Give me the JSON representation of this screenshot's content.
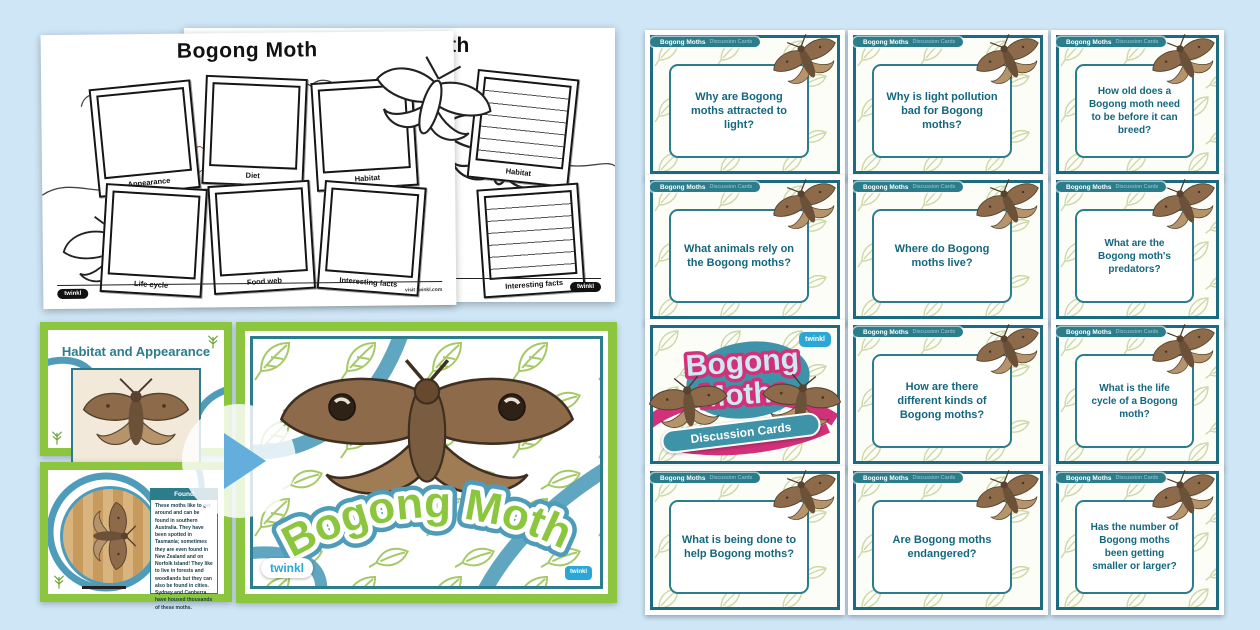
{
  "page": {
    "background": "#cfe6f6"
  },
  "worksheets": {
    "title": "Bogong Moth",
    "frames": [
      "Appearance",
      "Diet",
      "Habitat",
      "Life cycle",
      "Food web",
      "Interesting facts"
    ],
    "sheet2_frames": [
      "Habitat",
      "Interesting facts"
    ],
    "footer_note": "visit twinkl.com",
    "logo_text": "twinkl"
  },
  "slides": {
    "habitat_slide_title": "Habitat and Appearance",
    "found_heading": "Found",
    "found_body": "These moths like to get around and can be found in southern Australia. They have been spotted in Tasmania; sometimes they are even found in New Zealand and on Norfolk Island! They like to live in forests and woodlands but they can also be found in cities. Sydney and Canberra have housed thousands of these moths.",
    "main_title": "Bogong Moth",
    "logo_text": "twinkl"
  },
  "cards": {
    "badge_bold": "Bogong Moths",
    "badge_light": "Discussion Cards",
    "questions": [
      "Why are Bogong moths attracted to light?",
      "Why is light pollution bad for Bogong moths?",
      "How old does a Bogong moth need to be before it can breed?",
      "What animals rely on the Bogong moths?",
      "Where do Bogong moths live?",
      "What are the Bogong moth's predators?",
      "How are there different kinds of Bogong moths?",
      "What is the life cycle of a Bogong moth?",
      "What is being done to help Bogong moths?",
      "Are Bogong moths endangered?",
      "Has the number of Bogong moths been getting smaller or larger?"
    ],
    "title_card": {
      "line1": "Bogong",
      "line2": "Moths",
      "banner": "Discussion Cards",
      "logo_text": "twinkl"
    }
  },
  "colors": {
    "teal": "#1d6b80",
    "green": "#8cc63e",
    "pink": "#d23078",
    "ribbon": "#4f9cba"
  }
}
